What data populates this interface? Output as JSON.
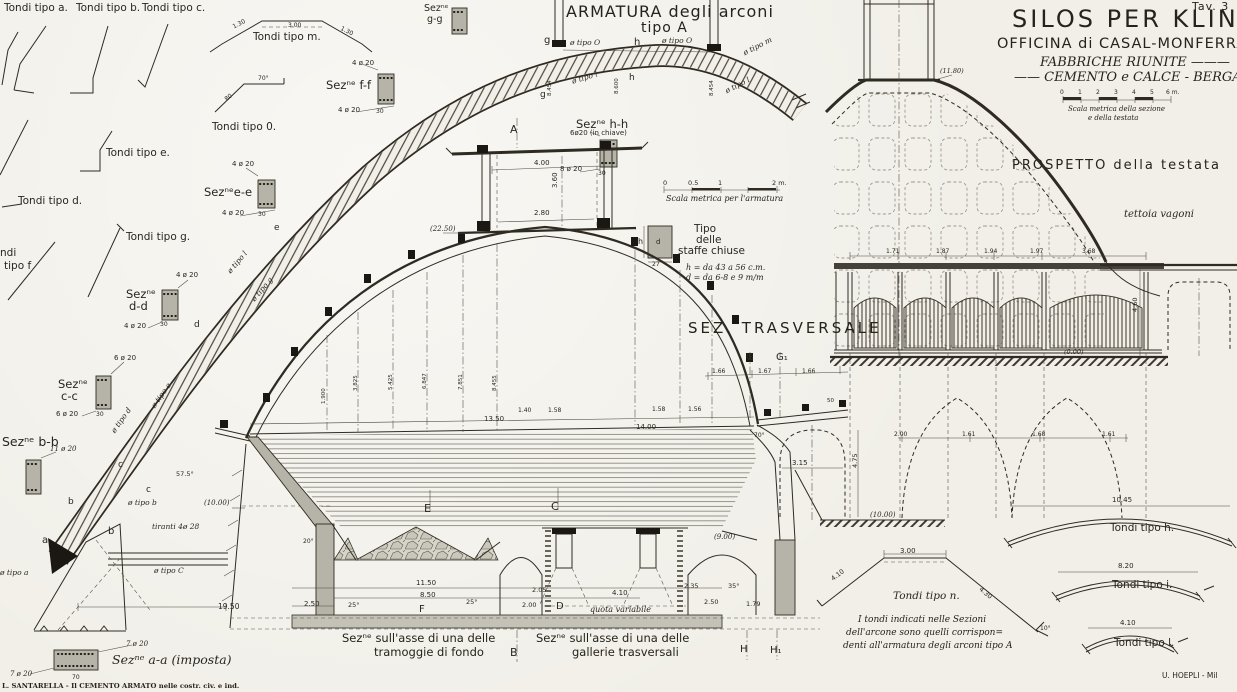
{
  "colors": {
    "paper": "#f1efe8",
    "ink": "#2f2b22",
    "concrete": "#b6b3a8",
    "dark_fill": "#1b1813"
  },
  "sheet": {
    "plate_no": "Tav. 3",
    "title_line1": "SILOS PER KLINKER",
    "title_line2": "OFFICINA di CASAL-MONFERRATO",
    "title_line3": "FABBRICHE RIUNITE ———",
    "title_line4": "—— CEMENTO e CALCE - BERGAMO",
    "imprint_left": "L. SANTARELLA - Il CEMENTO ARMATO nelle costr. civ. e ind.",
    "imprint_right": "U. HOEPLI - Mil"
  },
  "headings": {
    "armatura_line1": "ARMATURA degli arconi",
    "armatura_line2": "tipo A",
    "sez_trasversale": "SEZ. TRASVERSALE",
    "prospetto": "PROSPETTO della testata",
    "caption_tramoggie_1": "Sezⁿᵉ sull'asse di una delle",
    "caption_tramoggie_2": "tramoggie di fondo",
    "caption_gallerie_1": "Sezⁿᵉ sull'asse di una delle",
    "caption_gallerie_2": "gallerie trasversali",
    "note_line1": "I tondi indicati nelle Sezioni",
    "note_line2": "dell'arcone sono quelli corrispon=",
    "note_line3": "denti all'armatura degli arconi tipo A",
    "scala_armatura": "Scala metrica per l'armatura",
    "scala_sezione_1": "Scala metrica della sezione",
    "scala_sezione_2": "e della testata"
  },
  "annotations": [
    {
      "t": "Tondi tipo a.",
      "x": 4,
      "y": 3,
      "fs": 10.5,
      "n": "label-tondi-tipo-a"
    },
    {
      "t": "Tondi tipo b.",
      "x": 76,
      "y": 3,
      "fs": 10.5,
      "n": "label-tondi-tipo-b"
    },
    {
      "t": "Tondi tipo c.",
      "x": 142,
      "y": 3,
      "fs": 10.5,
      "n": "label-tondi-tipo-c"
    },
    {
      "t": "Tondi tipo m.",
      "x": 253,
      "y": 32,
      "fs": 10.5,
      "n": "label-tondi-tipo-m"
    },
    {
      "t": "Tondi tipo 0.",
      "x": 212,
      "y": 122,
      "fs": 10.5,
      "n": "label-tondi-tipo-0"
    },
    {
      "t": "Tondi tipo e.",
      "x": 106,
      "y": 148,
      "fs": 10.5,
      "n": "label-tondi-tipo-e"
    },
    {
      "t": "Tondi tipo d.",
      "x": 18,
      "y": 196,
      "fs": 10.5,
      "n": "label-tondi-tipo-d"
    },
    {
      "t": "Tondi tipo g.",
      "x": 126,
      "y": 232,
      "fs": 10.5,
      "n": "label-tondi-tipo-g"
    },
    {
      "t": "ndi",
      "x": 0,
      "y": 248,
      "fs": 10.5,
      "n": "label-tondi-tipo-f"
    },
    {
      "t": "tipo f",
      "x": 4,
      "y": 261,
      "fs": 10.5,
      "n": "label-tondi-tipo-f"
    },
    {
      "t": "1.30",
      "x": 232,
      "y": 25,
      "r": -27,
      "fs": 6
    },
    {
      "t": "3.00",
      "x": 288,
      "y": 23,
      "fs": 6
    },
    {
      "t": "1.30",
      "x": 342,
      "y": 26,
      "r": 27,
      "fs": 6
    },
    {
      "t": "70°",
      "x": 258,
      "y": 76,
      "fs": 6
    },
    {
      "t": "80",
      "x": 224,
      "y": 98,
      "r": -38,
      "fs": 6
    },
    {
      "t": "Sezⁿᵉ f-f",
      "x": 326,
      "y": 80,
      "fs": 11.5,
      "n": "label-sez-f-f"
    },
    {
      "t": "4 ø 20",
      "x": 352,
      "y": 60,
      "fs": 7
    },
    {
      "t": "4 ø 20",
      "x": 338,
      "y": 107,
      "fs": 7
    },
    {
      "t": "30",
      "x": 376,
      "y": 109,
      "fs": 6
    },
    {
      "t": "Sezⁿᵉe-e",
      "x": 204,
      "y": 187,
      "fs": 11.5,
      "n": "label-sez-e-e"
    },
    {
      "t": "4 ø 20",
      "x": 232,
      "y": 161,
      "fs": 7
    },
    {
      "t": "4 ø 20",
      "x": 222,
      "y": 210,
      "fs": 7
    },
    {
      "t": "30",
      "x": 258,
      "y": 212,
      "fs": 6
    },
    {
      "t": "Sezⁿᵉ",
      "x": 126,
      "y": 289,
      "fs": 11.5,
      "n": "label-sez-d-d"
    },
    {
      "t": "d-d",
      "x": 129,
      "y": 301,
      "fs": 11.5,
      "n": "label-sez-d-d"
    },
    {
      "t": "4 ø 20",
      "x": 176,
      "y": 272,
      "fs": 7
    },
    {
      "t": "4 ø 20",
      "x": 124,
      "y": 323,
      "fs": 7
    },
    {
      "t": "30",
      "x": 160,
      "y": 322,
      "fs": 6
    },
    {
      "t": "Sezⁿᵉ",
      "x": 58,
      "y": 379,
      "fs": 11.5,
      "n": "label-sez-c-c"
    },
    {
      "t": "c-c",
      "x": 61,
      "y": 391,
      "fs": 11.5,
      "n": "label-sez-c-c"
    },
    {
      "t": "6 ø 20",
      "x": 114,
      "y": 355,
      "fs": 7
    },
    {
      "t": "6 ø 20",
      "x": 56,
      "y": 411,
      "fs": 7
    },
    {
      "t": "30",
      "x": 96,
      "y": 412,
      "fs": 6
    },
    {
      "t": "Sezⁿᵉ b-b",
      "x": 2,
      "y": 436,
      "fs": 12.5,
      "n": "label-sez-b-b"
    },
    {
      "t": "11 ø 20",
      "x": 50,
      "y": 446,
      "fs": 7,
      "i": true
    },
    {
      "t": "Sezⁿᵉ",
      "x": 424,
      "y": 4,
      "fs": 9.5,
      "n": "label-sez-g-g"
    },
    {
      "t": "g-g",
      "x": 427,
      "y": 15,
      "fs": 9.5,
      "n": "label-sez-g-g"
    },
    {
      "t": "Sezⁿᵉ h-h",
      "x": 576,
      "y": 119,
      "fs": 11.5,
      "n": "label-sez-h-h"
    },
    {
      "t": "6ø20 (in chiave)",
      "x": 570,
      "y": 130,
      "fs": 7
    },
    {
      "t": "8 ø 20",
      "x": 560,
      "y": 166,
      "fs": 7
    },
    {
      "t": "30",
      "x": 598,
      "y": 171,
      "fs": 6
    },
    {
      "t": "Sezⁿᵉ a-a (imposta)",
      "x": 112,
      "y": 654,
      "fs": 12.5,
      "i": true,
      "n": "label-sez-a-a"
    },
    {
      "t": "7 ø 20",
      "x": 126,
      "y": 641,
      "fs": 7,
      "i": true
    },
    {
      "t": "7 ø 20",
      "x": 10,
      "y": 671,
      "fs": 7,
      "i": true
    },
    {
      "t": "70",
      "x": 72,
      "y": 675,
      "fs": 6
    },
    {
      "t": "Tipo",
      "x": 694,
      "y": 224,
      "fs": 10.5,
      "n": "label-staffe"
    },
    {
      "t": "delle",
      "x": 696,
      "y": 235,
      "fs": 10.5,
      "n": "label-staffe"
    },
    {
      "t": "staffe chiuse",
      "x": 678,
      "y": 246,
      "fs": 10.5,
      "n": "label-staffe"
    },
    {
      "t": "h = da 43 a 56 c.m.",
      "x": 686,
      "y": 264,
      "fs": 8,
      "i": true
    },
    {
      "t": "d = da 6-8 e 9 m/m",
      "x": 686,
      "y": 274,
      "fs": 8,
      "i": true
    },
    {
      "t": "h",
      "x": 638,
      "y": 238,
      "fs": 8
    },
    {
      "t": "d",
      "x": 656,
      "y": 239,
      "fs": 7
    },
    {
      "t": "27",
      "x": 652,
      "y": 262,
      "fs": 6
    },
    {
      "t": "a",
      "x": 42,
      "y": 536,
      "fs": 10
    },
    {
      "t": "b",
      "x": 108,
      "y": 527,
      "fs": 10
    },
    {
      "t": "b",
      "x": 68,
      "y": 498,
      "fs": 9
    },
    {
      "t": "c",
      "x": 118,
      "y": 461,
      "fs": 9
    },
    {
      "t": "c",
      "x": 146,
      "y": 486,
      "fs": 9
    },
    {
      "t": "d",
      "x": 194,
      "y": 321,
      "fs": 9
    },
    {
      "t": "e",
      "x": 274,
      "y": 224,
      "fs": 9
    },
    {
      "t": "ø tipo l",
      "x": 226,
      "y": 270,
      "r": -50,
      "fs": 7.5,
      "i": true
    },
    {
      "t": "ø tipo g",
      "x": 250,
      "y": 298,
      "r": -50,
      "fs": 7.5,
      "i": true
    },
    {
      "t": "ø tipo e",
      "x": 150,
      "y": 405,
      "r": -55,
      "fs": 7.5,
      "i": true
    },
    {
      "t": "ø tipo d",
      "x": 110,
      "y": 430,
      "r": -55,
      "fs": 7.5,
      "i": true
    },
    {
      "t": "ø tipo b",
      "x": 128,
      "y": 499,
      "fs": 7.5,
      "i": true
    },
    {
      "t": "57.5°",
      "x": 176,
      "y": 471,
      "fs": 6.5
    },
    {
      "t": "ø tipo a",
      "x": 0,
      "y": 569,
      "fs": 7.5,
      "i": true
    },
    {
      "t": "ø tipo C",
      "x": 154,
      "y": 567,
      "fs": 7.5,
      "i": true
    },
    {
      "t": "tiranti 4ø 28",
      "x": 152,
      "y": 523,
      "fs": 7.5,
      "i": true
    },
    {
      "t": "19.50",
      "x": 218,
      "y": 603,
      "fs": 7.5
    },
    {
      "t": "20°",
      "x": 303,
      "y": 539,
      "fs": 6
    },
    {
      "t": "g",
      "x": 544,
      "y": 36,
      "fs": 10
    },
    {
      "t": "ø tipo O",
      "x": 570,
      "y": 39,
      "fs": 7.5,
      "i": true
    },
    {
      "t": "h",
      "x": 634,
      "y": 38,
      "fs": 10
    },
    {
      "t": "ø tipo O",
      "x": 662,
      "y": 37,
      "fs": 7.5,
      "i": true
    },
    {
      "t": "ø tipo m",
      "x": 742,
      "y": 50,
      "r": -27,
      "fs": 7.5,
      "i": true
    },
    {
      "t": "ø tipo l",
      "x": 724,
      "y": 88,
      "r": -27,
      "fs": 7.5,
      "i": true
    },
    {
      "t": "ø tipo l",
      "x": 571,
      "y": 78,
      "r": -17,
      "fs": 7.5,
      "i": true
    },
    {
      "t": "h",
      "x": 629,
      "y": 74,
      "fs": 9
    },
    {
      "t": "g",
      "x": 540,
      "y": 91,
      "fs": 9
    },
    {
      "t": "8.454",
      "x": 548,
      "y": 96,
      "r": -90,
      "fs": 5.5
    },
    {
      "t": "8.600",
      "x": 615,
      "y": 94,
      "r": -90,
      "fs": 5.5
    },
    {
      "t": "8.454",
      "x": 710,
      "y": 96,
      "r": -90,
      "fs": 5.5
    },
    {
      "t": "0",
      "x": 663,
      "y": 180,
      "fs": 6.5
    },
    {
      "t": "0.5",
      "x": 688,
      "y": 180,
      "fs": 6.5
    },
    {
      "t": "1",
      "x": 718,
      "y": 180,
      "fs": 6.5
    },
    {
      "t": "2 m.",
      "x": 772,
      "y": 180,
      "fs": 6.5
    },
    {
      "t": "(22.50)",
      "x": 430,
      "y": 226,
      "fs": 7,
      "i": true
    },
    {
      "t": "A",
      "x": 510,
      "y": 124,
      "fs": 11,
      "n": "marker-A"
    },
    {
      "t": "4.00",
      "x": 534,
      "y": 160,
      "fs": 7
    },
    {
      "t": "3.60",
      "x": 552,
      "y": 188,
      "r": -90,
      "fs": 7
    },
    {
      "t": "2.80",
      "x": 534,
      "y": 210,
      "fs": 7
    },
    {
      "t": "1.900",
      "x": 322,
      "y": 404,
      "r": -90,
      "fs": 5.5
    },
    {
      "t": "3.825",
      "x": 354,
      "y": 391,
      "r": -90,
      "fs": 5.5
    },
    {
      "t": "5.425",
      "x": 389,
      "y": 390,
      "r": -90,
      "fs": 5.5
    },
    {
      "t": "6.847",
      "x": 423,
      "y": 389,
      "r": -90,
      "fs": 5.5
    },
    {
      "t": "7.851",
      "x": 459,
      "y": 390,
      "r": -90,
      "fs": 5.5
    },
    {
      "t": "8.455",
      "x": 493,
      "y": 391,
      "r": -90,
      "fs": 5.5
    },
    {
      "t": "13.50",
      "x": 484,
      "y": 416,
      "fs": 7
    },
    {
      "t": "14.00",
      "x": 636,
      "y": 424,
      "fs": 7
    },
    {
      "t": "1.40",
      "x": 518,
      "y": 408,
      "fs": 6
    },
    {
      "t": "1.58",
      "x": 548,
      "y": 408,
      "fs": 6
    },
    {
      "t": "1.58",
      "x": 652,
      "y": 407,
      "fs": 6
    },
    {
      "t": "1.56",
      "x": 688,
      "y": 407,
      "fs": 6
    },
    {
      "t": "(10.00)",
      "x": 204,
      "y": 500,
      "fs": 7,
      "i": true
    },
    {
      "t": "G",
      "x": 746,
      "y": 353,
      "fs": 10,
      "n": "marker-G"
    },
    {
      "t": "G₁",
      "x": 776,
      "y": 353,
      "fs": 10,
      "n": "marker-G1"
    },
    {
      "t": "1.66",
      "x": 712,
      "y": 369,
      "fs": 6
    },
    {
      "t": "1.67",
      "x": 758,
      "y": 369,
      "fs": 6
    },
    {
      "t": "1.66",
      "x": 802,
      "y": 369,
      "fs": 6
    },
    {
      "t": "50",
      "x": 827,
      "y": 399,
      "fs": 5.5
    },
    {
      "t": "70°",
      "x": 754,
      "y": 433,
      "fs": 6
    },
    {
      "t": "3.15",
      "x": 792,
      "y": 460,
      "fs": 7
    },
    {
      "t": "4.75",
      "x": 852,
      "y": 468,
      "r": -90,
      "fs": 6.5
    },
    {
      "t": "(10.00)",
      "x": 870,
      "y": 512,
      "fs": 7,
      "i": true
    },
    {
      "t": "(9.00)",
      "x": 714,
      "y": 534,
      "fs": 7,
      "i": true
    },
    {
      "t": "E",
      "x": 424,
      "y": 503,
      "fs": 11,
      "n": "marker-E"
    },
    {
      "t": "C",
      "x": 551,
      "y": 501,
      "fs": 11,
      "n": "marker-C"
    },
    {
      "t": "F",
      "x": 419,
      "y": 605,
      "fs": 10,
      "n": "marker-F"
    },
    {
      "t": "D",
      "x": 556,
      "y": 602,
      "fs": 10,
      "n": "marker-D"
    },
    {
      "t": "B",
      "x": 510,
      "y": 647,
      "fs": 11,
      "n": "marker-B"
    },
    {
      "t": "H",
      "x": 740,
      "y": 645,
      "fs": 10,
      "n": "marker-H"
    },
    {
      "t": "H₁",
      "x": 770,
      "y": 646,
      "fs": 10,
      "n": "marker-H1"
    },
    {
      "t": "11.50",
      "x": 416,
      "y": 580,
      "fs": 7
    },
    {
      "t": "8.50",
      "x": 420,
      "y": 592,
      "fs": 7
    },
    {
      "t": "2.50",
      "x": 304,
      "y": 601,
      "fs": 7
    },
    {
      "t": "25°",
      "x": 348,
      "y": 602,
      "fs": 6.5
    },
    {
      "t": "25°",
      "x": 466,
      "y": 599,
      "fs": 6.5
    },
    {
      "t": "2.05",
      "x": 532,
      "y": 587,
      "fs": 6.5
    },
    {
      "t": "4.10",
      "x": 612,
      "y": 590,
      "fs": 7
    },
    {
      "t": "2.35",
      "x": 684,
      "y": 583,
      "fs": 6.5
    },
    {
      "t": "2.00",
      "x": 522,
      "y": 602,
      "fs": 6.5
    },
    {
      "t": "quota variabile",
      "x": 590,
      "y": 606,
      "fs": 8,
      "i": true
    },
    {
      "t": "2.50",
      "x": 704,
      "y": 599,
      "fs": 6.5
    },
    {
      "t": "1.79",
      "x": 746,
      "y": 601,
      "fs": 6.5
    },
    {
      "t": "35°",
      "x": 728,
      "y": 583,
      "fs": 6.5
    },
    {
      "t": "(11.80)",
      "x": 940,
      "y": 68,
      "fs": 6.5,
      "i": true
    },
    {
      "t": "1.71",
      "x": 886,
      "y": 249,
      "fs": 6
    },
    {
      "t": "1.87",
      "x": 936,
      "y": 249,
      "fs": 6
    },
    {
      "t": "1.94",
      "x": 984,
      "y": 249,
      "fs": 6
    },
    {
      "t": "1.97",
      "x": 1030,
      "y": 249,
      "fs": 6
    },
    {
      "t": "3.68",
      "x": 1082,
      "y": 249,
      "fs": 6
    },
    {
      "t": "4.60",
      "x": 1132,
      "y": 312,
      "r": -90,
      "fs": 6.5
    },
    {
      "t": "(0.00)",
      "x": 1064,
      "y": 349,
      "fs": 6.5,
      "i": true
    },
    {
      "t": "2.00",
      "x": 894,
      "y": 432,
      "fs": 6
    },
    {
      "t": "1.61",
      "x": 962,
      "y": 432,
      "fs": 6
    },
    {
      "t": "1.68",
      "x": 1032,
      "y": 432,
      "fs": 6
    },
    {
      "t": "1.61",
      "x": 1102,
      "y": 432,
      "fs": 6
    },
    {
      "t": "tettoia vagoni",
      "x": 1124,
      "y": 210,
      "fs": 10,
      "i": true,
      "n": "label-tettoia-vagoni"
    },
    {
      "t": "0",
      "x": 1060,
      "y": 90,
      "fs": 6
    },
    {
      "t": "1",
      "x": 1078,
      "y": 90,
      "fs": 6
    },
    {
      "t": "2",
      "x": 1096,
      "y": 90,
      "fs": 6
    },
    {
      "t": "3",
      "x": 1114,
      "y": 90,
      "fs": 6
    },
    {
      "t": "4",
      "x": 1132,
      "y": 90,
      "fs": 6
    },
    {
      "t": "5",
      "x": 1150,
      "y": 90,
      "fs": 6
    },
    {
      "t": "6 m.",
      "x": 1166,
      "y": 90,
      "fs": 6
    },
    {
      "t": "Tondi tipo n.",
      "x": 893,
      "y": 591,
      "fs": 10.5,
      "i": true,
      "n": "label-tondi-tipo-n"
    },
    {
      "t": "3.00",
      "x": 900,
      "y": 548,
      "fs": 7
    },
    {
      "t": "4.10",
      "x": 830,
      "y": 577,
      "r": -37,
      "fs": 6.5
    },
    {
      "t": "4.30",
      "x": 982,
      "y": 586,
      "r": 40,
      "fs": 6.5
    },
    {
      "t": "10°",
      "x": 1040,
      "y": 626,
      "fs": 6
    },
    {
      "t": "Tondi tipo h.",
      "x": 1110,
      "y": 523,
      "fs": 10.5,
      "n": "label-tondi-tipo-h"
    },
    {
      "t": "10.45",
      "x": 1112,
      "y": 497,
      "fs": 7
    },
    {
      "t": "Tondi tipo i.",
      "x": 1112,
      "y": 580,
      "fs": 10.5,
      "n": "label-tondi-tipo-i"
    },
    {
      "t": "8.20",
      "x": 1118,
      "y": 563,
      "fs": 7
    },
    {
      "t": "Tondi tipo l.",
      "x": 1114,
      "y": 638,
      "fs": 10.5,
      "n": "label-tondi-tipo-l"
    },
    {
      "t": "4.10",
      "x": 1120,
      "y": 620,
      "fs": 7
    }
  ]
}
